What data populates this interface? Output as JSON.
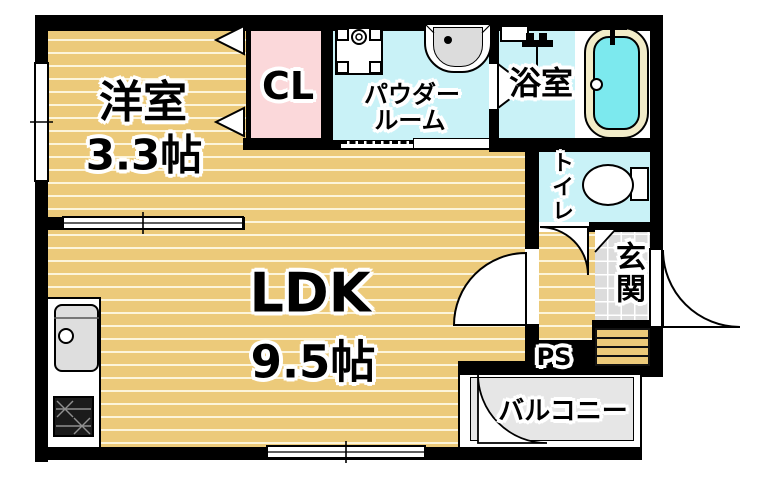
{
  "plan_type": "apartment-floorplan",
  "rooms": {
    "western_room": {
      "name": "洋室",
      "size": "3.3帖"
    },
    "closet": {
      "label": "CL"
    },
    "powder_room": {
      "name_line1": "パウダー",
      "name_line2": "ルーム"
    },
    "bathroom": {
      "name": "浴室"
    },
    "toilet": {
      "name": "トイレ"
    },
    "entrance": {
      "name": "玄関"
    },
    "ldk": {
      "name": "LDK",
      "size": "9.5帖"
    },
    "pipe_space": {
      "label": "PS"
    },
    "balcony": {
      "name": "バルコニー"
    }
  },
  "fixtures": [
    "kitchen-sink",
    "gas-stove",
    "washing-machine-pan",
    "wash-basin",
    "shower",
    "bathtub",
    "toilet-bowl"
  ],
  "colors": {
    "wood_floor": "#ecca7a",
    "floor_stripe": "#fffceb",
    "closet_pink": "#fbd8da",
    "wet_area_cyan": "#c9f2f7",
    "bath_water": "#7ce9ee",
    "tub_rim": "#f2ecc8",
    "entrance_tile": "#dcdcdc",
    "balcony_gray": "#e6e6e6",
    "wall": "#000000"
  }
}
